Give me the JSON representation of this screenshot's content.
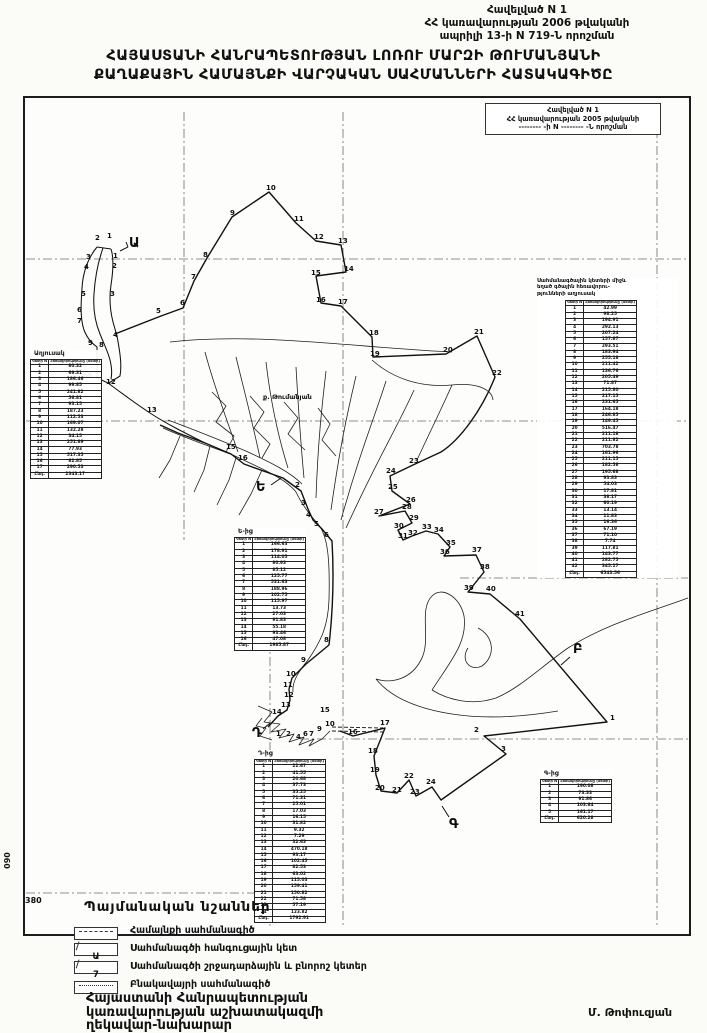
{
  "page": {
    "appendix": {
      "line1": "Հավելված N 1",
      "line2": "ՀՀ կառավարության 2006 թվականի",
      "line3": "ապրիլի 13-ի N 719-Ն որոշման"
    },
    "title_line1": "ՀԱՅԱՍՏԱՆԻ ՀԱՆՐԱՊԵՏՈՒԹՅԱՆ ԼՈՌՈՒ ՄԱՐԶԻ ԹՈՒՄԱՆՅԱՆԻ",
    "title_line2": "ՔԱՂԱՔԱՅԻՆ ՀԱՄԱՅՆՔԻ ՎԱՐՉԱԿԱՆ ՍԱՀՄԱՆՆԵՐԻ ՀԱՏԱԿԱԳԻԾԸ"
  },
  "map": {
    "inner_box": {
      "line1": "Հավելված N 1",
      "line2": "ՀՀ կառավարության 2005 թվականի",
      "line3": "-------- -ի N -------- -Ն որոշման"
    },
    "edge_label_left": "090",
    "edge_label_bottom": "380",
    "point_labels": [
      [
        95,
        240,
        "2"
      ],
      [
        107,
        238,
        "1"
      ],
      [
        86,
        259,
        "3"
      ],
      [
        84,
        269,
        "4"
      ],
      [
        113,
        258,
        "1"
      ],
      [
        112,
        268,
        "2"
      ],
      [
        110,
        296,
        "3"
      ],
      [
        81,
        296,
        "5"
      ],
      [
        77,
        312,
        "6"
      ],
      [
        77,
        323,
        "7"
      ],
      [
        113,
        337,
        "4"
      ],
      [
        156,
        313,
        "5"
      ],
      [
        180,
        305,
        "6"
      ],
      [
        191,
        279,
        "7"
      ],
      [
        203,
        257,
        "8"
      ],
      [
        230,
        215,
        "9"
      ],
      [
        266,
        190,
        "10"
      ],
      [
        294,
        221,
        "11"
      ],
      [
        88,
        345,
        "9"
      ],
      [
        99,
        347,
        "8"
      ],
      [
        82,
        378,
        "10"
      ],
      [
        106,
        384,
        "12"
      ],
      [
        147,
        412,
        "13"
      ],
      [
        226,
        449,
        "15"
      ],
      [
        238,
        460,
        "16"
      ],
      [
        314,
        239,
        "12"
      ],
      [
        338,
        243,
        "13"
      ],
      [
        344,
        271,
        "14"
      ],
      [
        311,
        275,
        "15"
      ],
      [
        316,
        302,
        "16"
      ],
      [
        338,
        304,
        "17"
      ],
      [
        369,
        335,
        "18"
      ],
      [
        370,
        356,
        "19"
      ],
      [
        443,
        352,
        "20"
      ],
      [
        474,
        334,
        "21"
      ],
      [
        492,
        375,
        "22"
      ],
      [
        409,
        463,
        "23"
      ],
      [
        386,
        473,
        "24"
      ],
      [
        388,
        489,
        "25"
      ],
      [
        406,
        502,
        "26"
      ],
      [
        374,
        514,
        "27"
      ],
      [
        402,
        509,
        "28"
      ],
      [
        409,
        520,
        "29"
      ],
      [
        394,
        528,
        "30"
      ],
      [
        398,
        538,
        "31"
      ],
      [
        408,
        535,
        "32"
      ],
      [
        422,
        529,
        "33"
      ],
      [
        434,
        532,
        "34"
      ],
      [
        446,
        545,
        "35"
      ],
      [
        440,
        554,
        "36"
      ],
      [
        472,
        552,
        "37"
      ],
      [
        480,
        569,
        "38"
      ],
      [
        464,
        590,
        "39"
      ],
      [
        486,
        591,
        "40"
      ],
      [
        515,
        616,
        "41"
      ],
      [
        610,
        720,
        "1"
      ],
      [
        474,
        732,
        "2"
      ],
      [
        501,
        751,
        "3"
      ],
      [
        324,
        642,
        "8"
      ],
      [
        301,
        662,
        "9"
      ],
      [
        286,
        676,
        "10"
      ],
      [
        283,
        687,
        "11"
      ],
      [
        284,
        697,
        "12"
      ],
      [
        281,
        707,
        "13"
      ],
      [
        272,
        714,
        "14"
      ],
      [
        320,
        712,
        "15"
      ],
      [
        348,
        734,
        "16"
      ],
      [
        380,
        725,
        "17"
      ],
      [
        368,
        753,
        "18"
      ],
      [
        370,
        772,
        "19"
      ],
      [
        375,
        790,
        "20"
      ],
      [
        392,
        792,
        "21"
      ],
      [
        404,
        778,
        "22"
      ],
      [
        410,
        794,
        "23"
      ],
      [
        426,
        784,
        "24"
      ],
      [
        276,
        736,
        "1"
      ],
      [
        286,
        736,
        "2"
      ],
      [
        296,
        739,
        "4"
      ],
      [
        303,
        736,
        "6"
      ],
      [
        309,
        736,
        "7"
      ],
      [
        317,
        731,
        "9"
      ],
      [
        325,
        726,
        "10"
      ],
      [
        295,
        487,
        "2"
      ],
      [
        301,
        505,
        "3"
      ],
      [
        306,
        517,
        "4"
      ],
      [
        314,
        526,
        "5"
      ],
      [
        324,
        537,
        "6"
      ],
      [
        129,
        247,
        "Ա",
        "L"
      ],
      [
        256,
        491,
        "Ե",
        "L"
      ],
      [
        573,
        653,
        "Բ",
        "L"
      ],
      [
        252,
        737,
        "Դ",
        "L"
      ],
      [
        449,
        828,
        "Գ",
        "L"
      ],
      [
        263,
        399,
        "ք. Թումանյան",
        "p"
      ]
    ]
  },
  "tables": {
    "left": {
      "label": "Աղյուսակ",
      "col1": "Կետի N",
      "col2": "Հեռավորությունը (մետր)",
      "rows": [
        [
          "1",
          "80.32"
        ],
        [
          "2",
          "69.31"
        ],
        [
          "3",
          "186.46"
        ],
        [
          "4",
          "99.85"
        ],
        [
          "5",
          "241.82"
        ],
        [
          "6",
          "56.81"
        ],
        [
          "7",
          "93.15"
        ],
        [
          "8",
          "187.23"
        ],
        [
          "9",
          "112.53"
        ],
        [
          "10",
          "169.07"
        ],
        [
          "11",
          "132.28"
        ],
        [
          "12",
          "34.15"
        ],
        [
          "13",
          "251.89"
        ],
        [
          "14",
          "77.93"
        ],
        [
          "15",
          "517.35"
        ],
        [
          "16",
          "82.85"
        ],
        [
          "17",
          "290.53"
        ]
      ],
      "total_label": "Ընդ.",
      "total": "2343.17"
    },
    "middle": {
      "label": "Ե-ից",
      "col1": "Կետի N",
      "col2": "Հեռավորությունը (մետր)",
      "rows": [
        [
          "1",
          "166.63"
        ],
        [
          "2",
          "178.91"
        ],
        [
          "3",
          "114.05"
        ],
        [
          "4",
          "80.93"
        ],
        [
          "5",
          "85.12"
        ],
        [
          "6",
          "125.77"
        ],
        [
          "7",
          "531.63"
        ],
        [
          "8",
          "188.96"
        ],
        [
          "9",
          "102.75"
        ],
        [
          "10",
          "115.97"
        ],
        [
          "11",
          "13.73"
        ],
        [
          "12",
          "27.03"
        ],
        [
          "13",
          "91.83"
        ],
        [
          "14",
          "55.18"
        ],
        [
          "15",
          "93.46"
        ],
        [
          "16",
          "47.08"
        ]
      ],
      "total_label": "Ընդ.",
      "total": "1985.87"
    },
    "bottom": {
      "label": "Դ-ից",
      "col1": "Կետի N",
      "col2": "Հեռավորությունը (մետր)",
      "rows": [
        [
          "1",
          "22.67"
        ],
        [
          "2",
          "41.55"
        ],
        [
          "3",
          "20.68"
        ],
        [
          "4",
          "37.73"
        ],
        [
          "5",
          "35.25"
        ],
        [
          "6",
          "71.31"
        ],
        [
          "7",
          "25.01"
        ],
        [
          "8",
          "17.03"
        ],
        [
          "9",
          "16.15"
        ],
        [
          "10",
          "31.82"
        ],
        [
          "11",
          "9.32"
        ],
        [
          "12",
          "7.29"
        ],
        [
          "13",
          "32.63"
        ],
        [
          "14",
          "470.18"
        ],
        [
          "15",
          "93.17"
        ],
        [
          "16",
          "102.45"
        ],
        [
          "17",
          "82.53"
        ],
        [
          "18",
          "63.02"
        ],
        [
          "19",
          "115.03"
        ],
        [
          "20",
          "159.41"
        ],
        [
          "21",
          "150.82"
        ],
        [
          "22",
          "71.58"
        ],
        [
          "23",
          "57.19"
        ],
        [
          "24",
          "123.82"
        ]
      ],
      "total_label": "Ընդ.",
      "total": "1792.91"
    },
    "right": {
      "header_lines": [
        "Սահմանագծային կետերի միջև",
        "եղած գծային հեռավորու-",
        "թյունների աղյուսակ"
      ],
      "col1": "Կետի N",
      "col2": "Հեռավորությունը (մետր)",
      "rows": [
        [
          "1",
          "42.99"
        ],
        [
          "2",
          "98.25"
        ],
        [
          "3",
          "194.91"
        ],
        [
          "4",
          "292.13"
        ],
        [
          "5",
          "207.24"
        ],
        [
          "6",
          "157.87"
        ],
        [
          "7",
          "293.51"
        ],
        [
          "8",
          "183.94"
        ],
        [
          "9",
          "255.18"
        ],
        [
          "10",
          "211.42"
        ],
        [
          "11",
          "136.76"
        ],
        [
          "12",
          "205.49"
        ],
        [
          "13",
          "71.87"
        ],
        [
          "14",
          "215.80"
        ],
        [
          "15",
          "217.15"
        ],
        [
          "16",
          "231.65"
        ],
        [
          "17",
          "164.18"
        ],
        [
          "18",
          "246.85"
        ],
        [
          "19",
          "149.45"
        ],
        [
          "20",
          "516.47"
        ],
        [
          "21",
          "211.18"
        ],
        [
          "22",
          "211.82"
        ],
        [
          "23",
          "703.78"
        ],
        [
          "24",
          "161.96"
        ],
        [
          "25",
          "211.15"
        ],
        [
          "26",
          "182.58"
        ],
        [
          "27",
          "195.68"
        ],
        [
          "28",
          "93.83"
        ],
        [
          "29",
          "54.03"
        ],
        [
          "30",
          "17.81"
        ],
        [
          "31",
          "38.17"
        ],
        [
          "32",
          "60.19"
        ],
        [
          "33",
          "13.14"
        ],
        [
          "34",
          "11.83"
        ],
        [
          "35",
          "16.36"
        ],
        [
          "36",
          "67.19"
        ],
        [
          "37",
          "71.10"
        ],
        [
          "38",
          "7.74"
        ],
        [
          "39",
          "117.81"
        ],
        [
          "40",
          "143.77"
        ],
        [
          "41",
          "282.75"
        ],
        [
          "42",
          "345.17"
        ]
      ],
      "total_label": "Ընդ.",
      "total": "6543.56"
    },
    "small": {
      "label": "Գ-ից",
      "col1": "Կետի N",
      "col2": "Հեռավորությունը (մետր)",
      "rows": [
        [
          "1",
          "190.08"
        ],
        [
          "2",
          "73.33"
        ],
        [
          "3",
          "91.86"
        ],
        [
          "4",
          "103.84"
        ],
        [
          "5",
          "161.17"
        ]
      ],
      "total_label": "Ընդ.",
      "total": "620.28"
    }
  },
  "legend": {
    "title": "Պայմանական նշաններ",
    "items": [
      {
        "icon": "community-boundary-line",
        "label": "Համայնքի սահմանագիծ"
      },
      {
        "icon": "junction-point",
        "glyph": "Ա",
        "label": "Սահմանագծի հանգուցային կետ"
      },
      {
        "icon": "turning-point",
        "glyph": "7",
        "label": "Սահմանագծի շրջադարձային և բնորոշ կետեր"
      },
      {
        "icon": "settlement-boundary-line",
        "label": "Բնակավայրի սահմանագիծ"
      }
    ]
  },
  "footer": {
    "lines": [
      "Հայաստանի Հանրապետության",
      "կառավարության աշխատակազմի",
      "ղեկավար-նախարար"
    ],
    "signature": "Մ. Թոփուզյան"
  }
}
